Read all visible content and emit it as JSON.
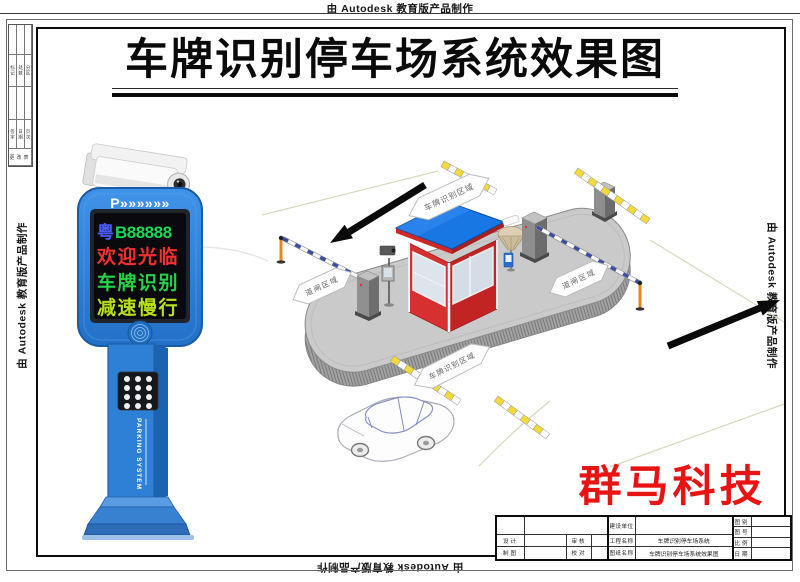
{
  "watermark": {
    "text": "由 Autodesk 教育版产品制作"
  },
  "title": "车牌识别停车场系统效果图",
  "brand": "群马科技",
  "kiosk": {
    "header": "P»»»»»»",
    "screen": {
      "plate_region": "粤",
      "plate_number": "B88888",
      "line2": "欢迎光临",
      "line3": "车牌识别",
      "line4": "减速慢行"
    },
    "side_label": "PARKING SYSTEM",
    "colors": {
      "body_blue": "#2e80d6",
      "plate_region": "#4a5cff",
      "plate_number": "#18d858",
      "line2": "#f23030",
      "line3": "#28d048",
      "line4": "#b8e018"
    }
  },
  "scene": {
    "labels": {
      "entry": "车牌识别区域",
      "exit": "车牌识别区域",
      "gate_in": "道闸区域",
      "gate_out": "道闸区域"
    },
    "colors": {
      "roof": "#1877e2",
      "wall": "#d63030",
      "island": "#cacaca",
      "barrier_post": "#e8871c",
      "bump_yellow": "#f2da3a"
    }
  },
  "title_block": {
    "left": {
      "r1": [
        "",
        ""
      ],
      "r2": [
        "设计",
        "",
        "审核",
        ""
      ],
      "r3": [
        "制图",
        "",
        "校对",
        ""
      ]
    },
    "middle": {
      "r1": [
        "建设单位",
        ""
      ],
      "r2": [
        "工程名称",
        "车牌识别停车场系统"
      ],
      "r3": [
        "图纸名称",
        "车牌识别停车场系统效果图"
      ]
    },
    "right": {
      "r1": [
        "图别",
        ""
      ],
      "r2": [
        "图号",
        ""
      ],
      "r3": [
        "比例",
        ""
      ],
      "r4": [
        "日期",
        ""
      ]
    }
  },
  "margin_table": {
    "row_a": [
      "标记",
      "处数",
      "分区"
    ],
    "row_b": [
      "签字",
      "日期",
      "页次"
    ],
    "footer": "更改表"
  }
}
